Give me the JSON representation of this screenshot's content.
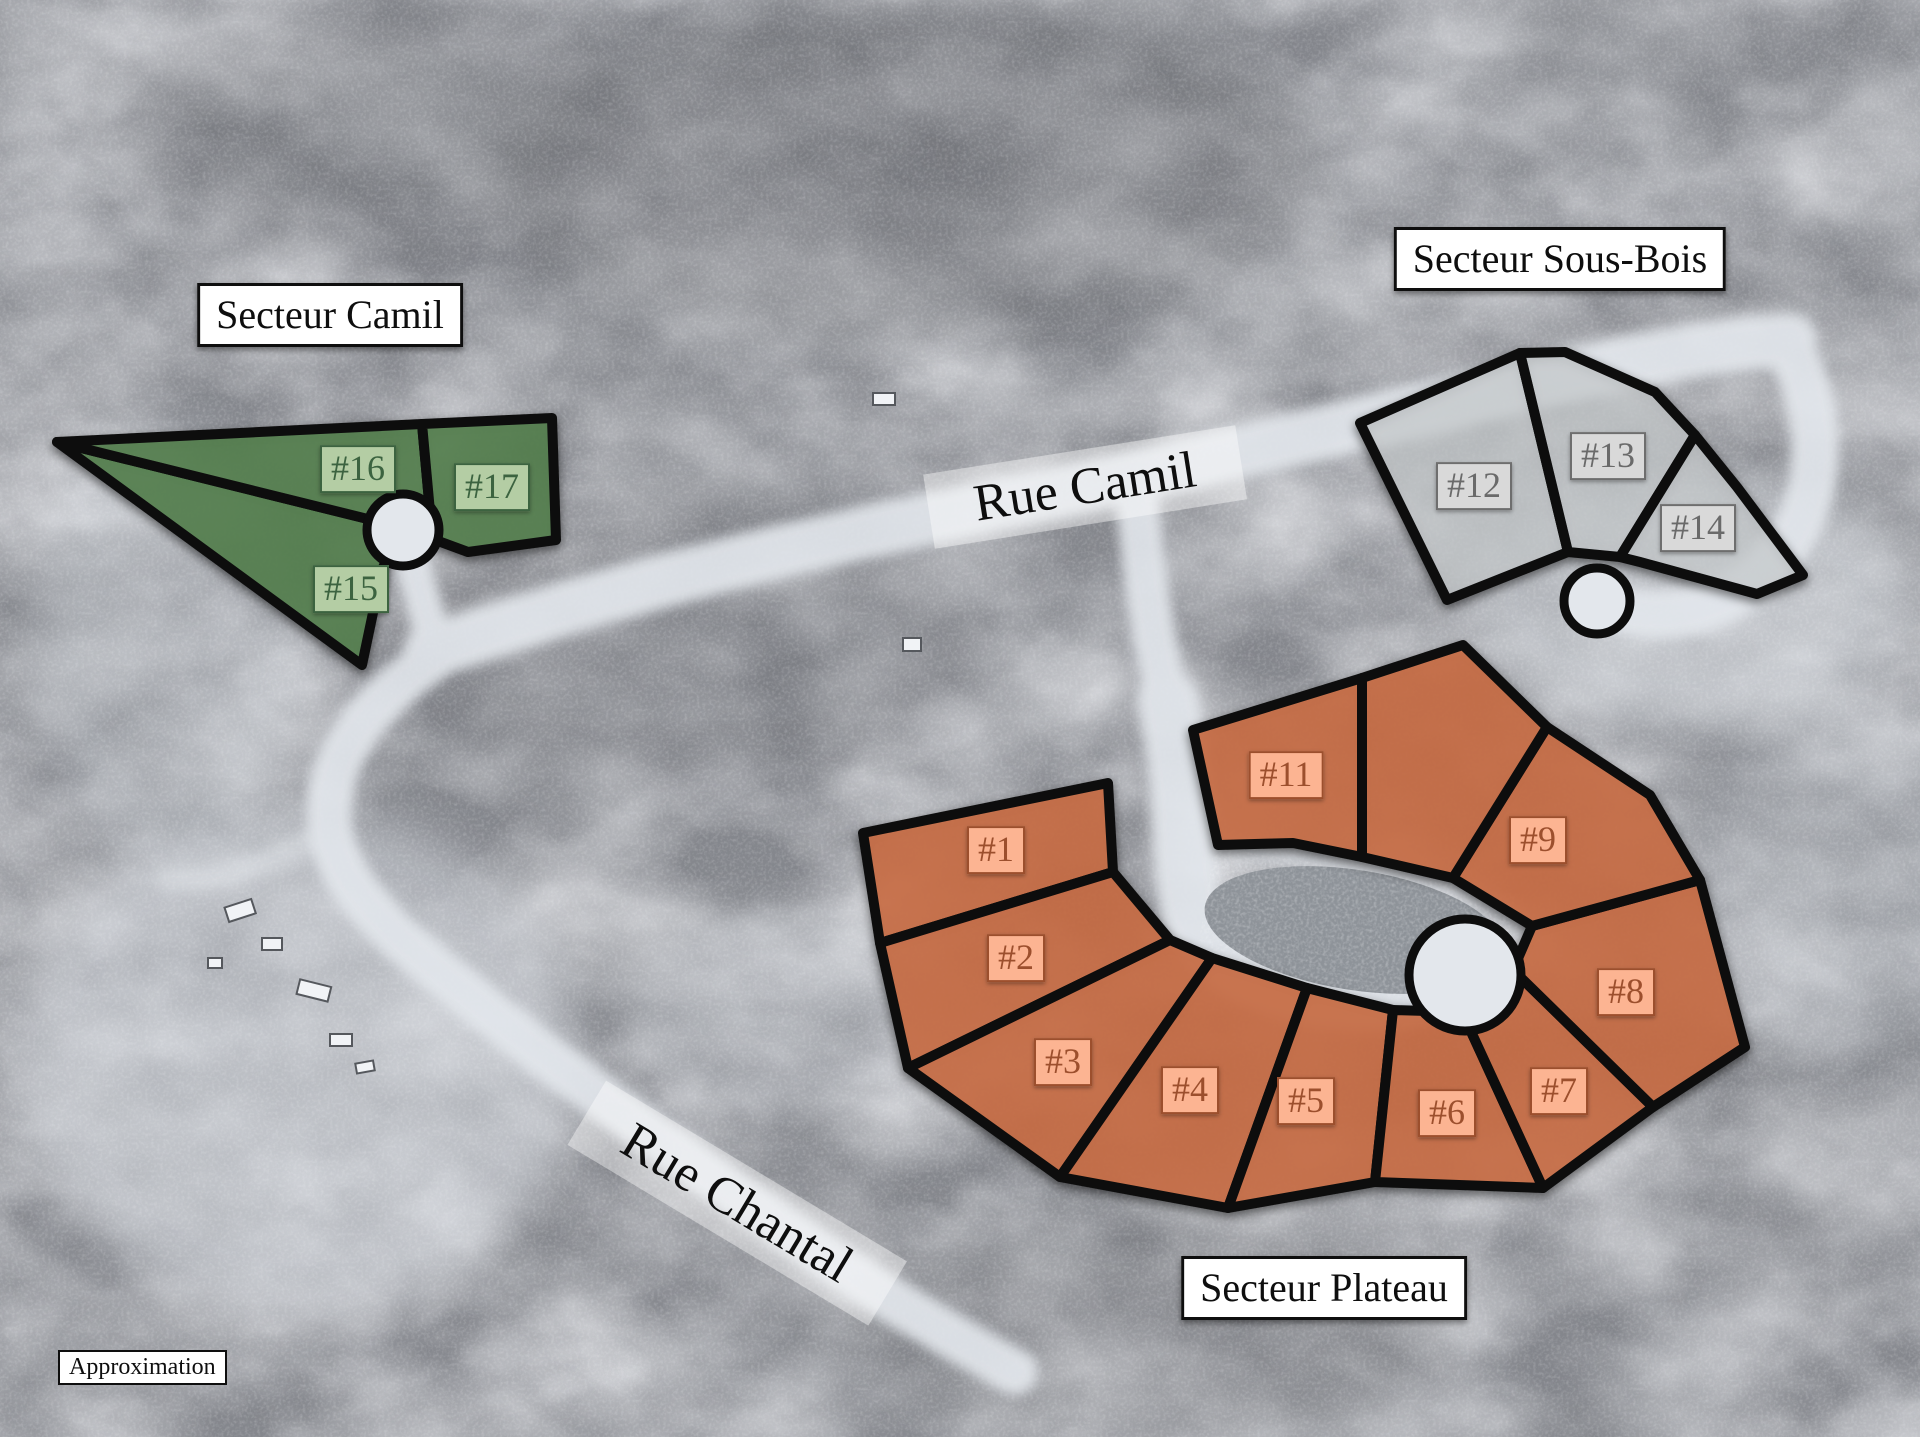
{
  "map": {
    "attribution": {
      "text": "Approximation",
      "x": 58,
      "y": 1350
    },
    "road_labels": [
      {
        "id": "rue-camil",
        "name": "Rue Camil",
        "x": 1085,
        "y": 487,
        "angle": -9
      },
      {
        "id": "rue-chantal",
        "name": "Rue Chantal",
        "x": 737,
        "y": 1203,
        "angle": 31
      }
    ],
    "sectors": [
      {
        "id": "camil",
        "name": "Secteur Camil",
        "name_pos": {
          "x": 330,
          "y": 315
        },
        "theme": {
          "fill": "#55814f",
          "fill_opacity": 0.85,
          "label_bg": "#b4cda4",
          "label_fg": "#3c6340",
          "label_border": "#3c6340"
        },
        "lots": [
          {
            "id": "15",
            "label": "#15",
            "points": "57,442 400,527 382,570 362,665",
            "label_pos": {
              "x": 351,
              "y": 589
            }
          },
          {
            "id": "16",
            "label": "#16",
            "points": "57,442 422,424 430,512 400,527",
            "label_pos": {
              "x": 358,
              "y": 469
            }
          },
          {
            "id": "17",
            "label": "#17",
            "points": "422,424 552,418 556,540 468,552 400,527 430,512",
            "label_pos": {
              "x": 492,
              "y": 487
            }
          }
        ]
      },
      {
        "id": "sous-bois",
        "name": "Secteur Sous-Bois",
        "name_pos": {
          "x": 1560,
          "y": 259
        },
        "theme": {
          "fill": "#d6d8db",
          "fill_opacity": 0.55,
          "label_bg": "#d9d9d9",
          "label_fg": "#6a6a6a",
          "label_border": "#6e6e6e"
        },
        "lots": [
          {
            "id": "12",
            "label": "#12",
            "points": "1360,423 1520,353 1568,552 1447,600",
            "label_pos": {
              "x": 1474,
              "y": 486
            }
          },
          {
            "id": "13",
            "label": "#13",
            "points": "1520,353 1565,352 1655,392 1695,435 1620,557 1568,552",
            "label_pos": {
              "x": 1608,
              "y": 456
            }
          },
          {
            "id": "14",
            "label": "#14",
            "points": "1695,435 1737,487 1803,575 1757,594 1640,562 1620,557",
            "label_pos": {
              "x": 1698,
              "y": 528
            }
          }
        ]
      },
      {
        "id": "plateau",
        "name": "Secteur Plateau",
        "name_pos": {
          "x": 1324,
          "y": 1288
        },
        "theme": {
          "fill": "#cd6f44",
          "fill_opacity": 0.85,
          "label_bg": "#fcb492",
          "label_fg": "#9c4f2d",
          "label_border": "#9c4f2d"
        },
        "lots": [
          {
            "id": "1",
            "label": "#1",
            "points": "863,833 1108,783 1113,872 880,943",
            "label_pos": {
              "x": 996,
              "y": 850
            }
          },
          {
            "id": "2",
            "label": "#2",
            "points": "880,943 1113,872 1170,940 908,1068",
            "label_pos": {
              "x": 1016,
              "y": 958
            }
          },
          {
            "id": "3",
            "label": "#3",
            "points": "908,1068 1170,940 1212,958 1060,1177",
            "label_pos": {
              "x": 1063,
              "y": 1062
            }
          },
          {
            "id": "4",
            "label": "#4",
            "points": "1060,1177 1212,958 1307,988 1228,1208",
            "label_pos": {
              "x": 1190,
              "y": 1090
            }
          },
          {
            "id": "5",
            "label": "#5",
            "points": "1228,1208 1307,988 1393,1010 1375,1182",
            "label_pos": {
              "x": 1306,
              "y": 1101
            }
          },
          {
            "id": "6",
            "label": "#6",
            "points": "1375,1182 1393,1010 1462,1012 1543,1188",
            "label_pos": {
              "x": 1447,
              "y": 1113
            }
          },
          {
            "id": "7",
            "label": "#7",
            "points": "1543,1188 1462,1012 1513,970 1653,1107",
            "label_pos": {
              "x": 1559,
              "y": 1091
            }
          },
          {
            "id": "8",
            "label": "#8",
            "points": "1653,1107 1513,970 1532,926 1700,880 1745,1047",
            "label_pos": {
              "x": 1626,
              "y": 992
            }
          },
          {
            "id": "9",
            "label": "#9",
            "points": "1453,878 1547,727 1650,795 1700,880 1532,926",
            "label_pos": {
              "x": 1538,
              "y": 840
            }
          },
          {
            "id": "10",
            "label": "",
            "points": "1362,678 1463,645 1547,727 1453,878 1362,857",
            "label_pos": null
          },
          {
            "id": "11",
            "label": "#11",
            "points": "1193,730 1362,678 1362,857 1293,843 1218,845",
            "label_pos": {
              "x": 1286,
              "y": 775
            }
          }
        ]
      }
    ]
  }
}
